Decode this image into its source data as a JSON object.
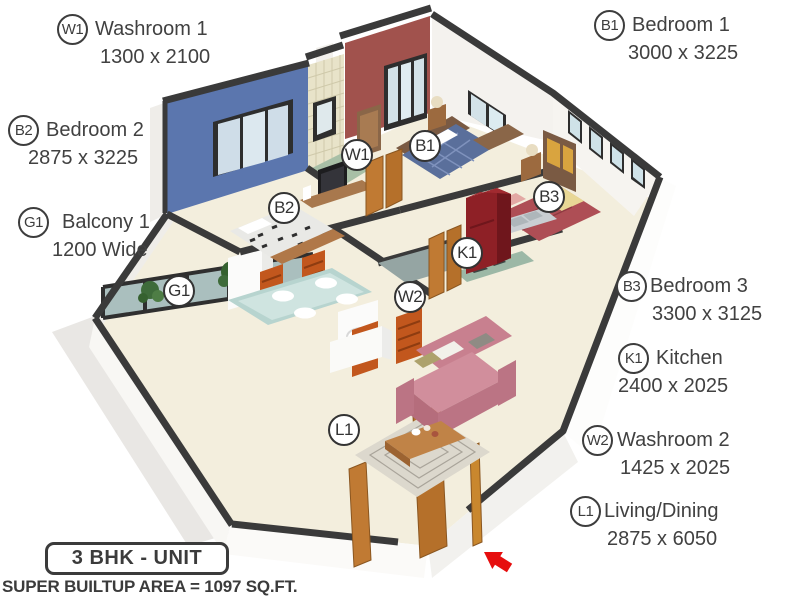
{
  "legend": {
    "items": [
      {
        "code": "W1",
        "name": "Washroom 1",
        "dims": "1300 x 2100"
      },
      {
        "code": "B1",
        "name": "Bedroom 1",
        "dims": "3000 x 3225"
      },
      {
        "code": "B2",
        "name": "Bedroom 2",
        "dims": "2875 x 3225"
      },
      {
        "code": "G1",
        "name": "Balcony 1",
        "dims": "1200 Wide"
      },
      {
        "code": "B3",
        "name": "Bedroom 3",
        "dims": "3300 x 3125"
      },
      {
        "code": "K1",
        "name": "Kitchen",
        "dims": "2400 x 2025"
      },
      {
        "code": "W2",
        "name": "Washroom 2",
        "dims": "1425 x 2025"
      },
      {
        "code": "L1",
        "name": "Living/Dining",
        "dims": "2875 x 6050"
      }
    ]
  },
  "plan": {
    "badges": [
      {
        "code": "W1"
      },
      {
        "code": "B1"
      },
      {
        "code": "B2"
      },
      {
        "code": "B3"
      },
      {
        "code": "K1"
      },
      {
        "code": "W2"
      },
      {
        "code": "G1"
      },
      {
        "code": "L1"
      }
    ],
    "entrance_arrow_icon": "entrance-arrow",
    "colors": {
      "accent_blue": "#5b76ae",
      "accent_maroon": "#a1524d",
      "wall_top": "#3a3a3a",
      "floor_cream": "#f3eedd",
      "wood_door": "#c07a33",
      "sofa_pink": "#c8808f",
      "fridge_red": "#8e2026",
      "arrow_red": "#e60e0e",
      "tile_beige": "#e8e3c9"
    }
  },
  "footer": {
    "unit_type": "3 BHK - UNIT",
    "area": "SUPER BUILTUP AREA = 1097 SQ.FT."
  }
}
